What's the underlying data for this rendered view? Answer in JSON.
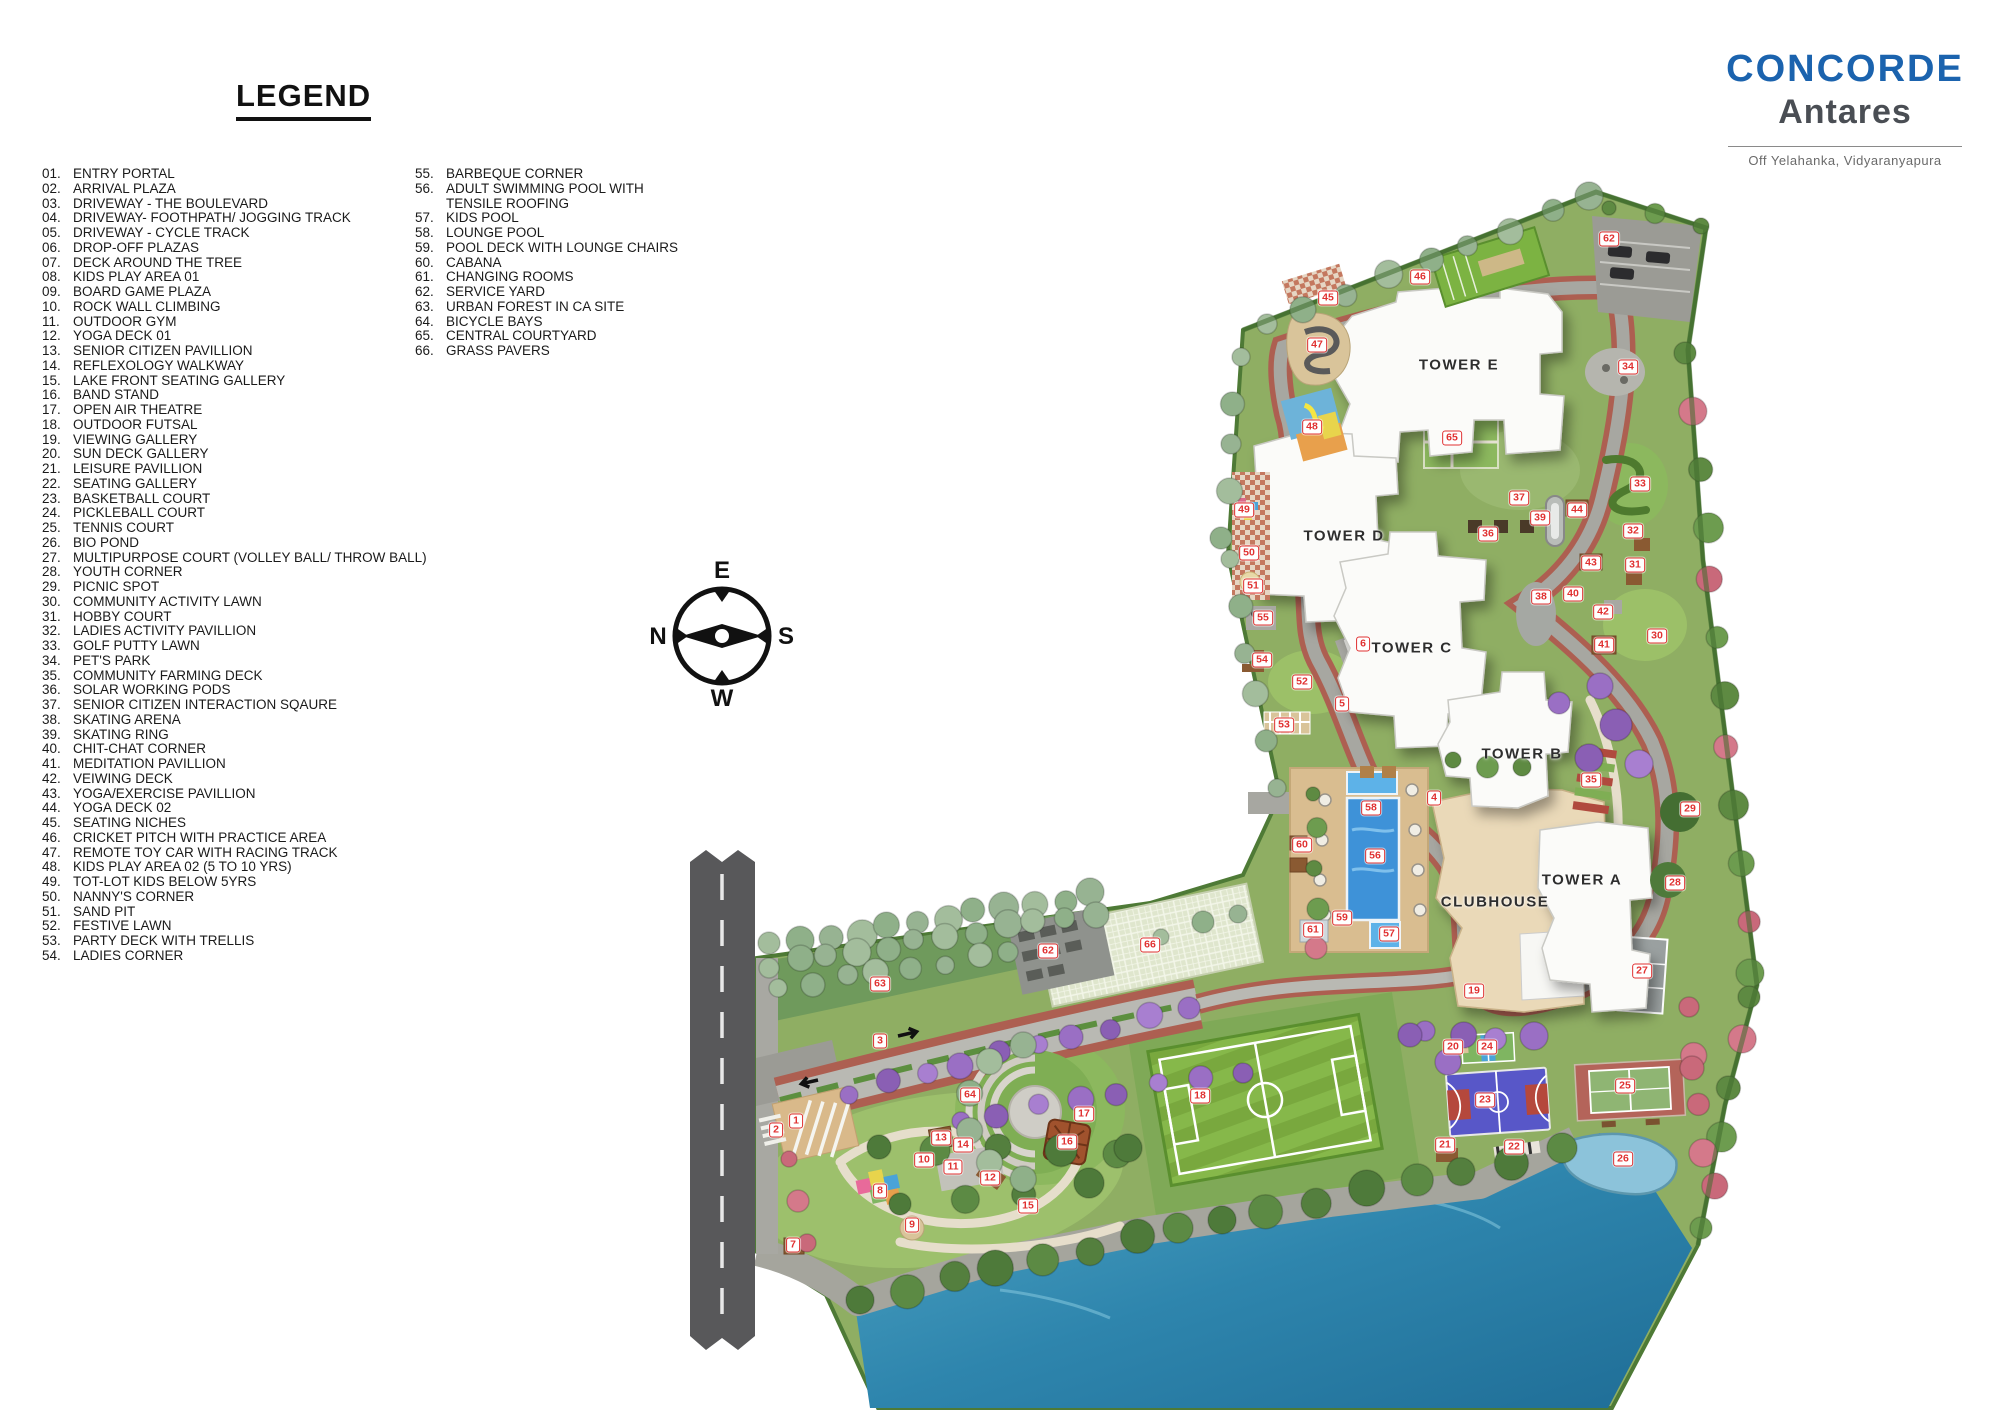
{
  "legend": {
    "title": "LEGEND",
    "column1": [
      {
        "n": "01.",
        "label": "ENTRY PORTAL"
      },
      {
        "n": "02.",
        "label": "ARRIVAL PLAZA"
      },
      {
        "n": "03.",
        "label": "DRIVEWAY - THE BOULEVARD"
      },
      {
        "n": "04.",
        "label": "DRIVEWAY- FOOTHPATH/ JOGGING TRACK"
      },
      {
        "n": "05.",
        "label": "DRIVEWAY - CYCLE TRACK"
      },
      {
        "n": "06.",
        "label": "DROP-OFF PLAZAS"
      },
      {
        "n": "07.",
        "label": "DECK AROUND THE TREE"
      },
      {
        "n": "08.",
        "label": "KIDS PLAY AREA 01"
      },
      {
        "n": "09.",
        "label": "BOARD GAME PLAZA"
      },
      {
        "n": "10.",
        "label": "ROCK WALL CLIMBING"
      },
      {
        "n": "11.",
        "label": "OUTDOOR GYM"
      },
      {
        "n": "12.",
        "label": "YOGA DECK 01"
      },
      {
        "n": "13.",
        "label": "SENIOR CITIZEN PAVILLION"
      },
      {
        "n": "14.",
        "label": "REFLEXOLOGY WALKWAY"
      },
      {
        "n": "15.",
        "label": "LAKE FRONT SEATING GALLERY"
      },
      {
        "n": "16.",
        "label": "BAND STAND"
      },
      {
        "n": "17.",
        "label": "OPEN AIR THEATRE"
      },
      {
        "n": "18.",
        "label": "OUTDOOR FUTSAL"
      },
      {
        "n": "19.",
        "label": "VIEWING GALLERY"
      },
      {
        "n": "20.",
        "label": "SUN DECK GALLERY"
      },
      {
        "n": "21.",
        "label": "LEISURE PAVILLION"
      },
      {
        "n": "22.",
        "label": "SEATING GALLERY"
      },
      {
        "n": "23.",
        "label": "BASKETBALL COURT"
      },
      {
        "n": "24.",
        "label": "PICKLEBALL COURT"
      },
      {
        "n": "25.",
        "label": "TENNIS COURT"
      },
      {
        "n": "26.",
        "label": "BIO POND"
      },
      {
        "n": "27.",
        "label": "MULTIPURPOSE COURT (VOLLEY BALL/ THROW BALL)"
      },
      {
        "n": "28.",
        "label": "YOUTH CORNER"
      },
      {
        "n": "29.",
        "label": "PICNIC SPOT"
      },
      {
        "n": "30.",
        "label": "COMMUNITY ACTIVITY LAWN"
      },
      {
        "n": "31.",
        "label": "HOBBY COURT"
      },
      {
        "n": "32.",
        "label": "LADIES ACTIVITY PAVILLION"
      },
      {
        "n": "33.",
        "label": "GOLF PUTTY LAWN"
      },
      {
        "n": "34.",
        "label": "PET'S PARK"
      },
      {
        "n": "35.",
        "label": "COMMUNITY FARMING DECK"
      },
      {
        "n": "36.",
        "label": "SOLAR WORKING PODS"
      },
      {
        "n": "37.",
        "label": "SENIOR CITIZEN INTERACTION SQAURE"
      },
      {
        "n": "38.",
        "label": "SKATING ARENA"
      },
      {
        "n": "39.",
        "label": "SKATING RING"
      },
      {
        "n": "40.",
        "label": "CHIT-CHAT CORNER"
      },
      {
        "n": "41.",
        "label": "MEDITATION PAVILLION"
      },
      {
        "n": "42.",
        "label": "VEIWING DECK"
      },
      {
        "n": "43.",
        "label": "YOGA/EXERCISE PAVILLION"
      },
      {
        "n": "44.",
        "label": "YOGA DECK 02"
      },
      {
        "n": "45.",
        "label": "SEATING NICHES"
      },
      {
        "n": "46.",
        "label": "CRICKET PITCH WITH PRACTICE AREA"
      },
      {
        "n": "47.",
        "label": "REMOTE TOY CAR WITH RACING TRACK"
      },
      {
        "n": "48.",
        "label": "KIDS PLAY AREA 02 (5 TO 10 YRS)"
      },
      {
        "n": "49.",
        "label": "TOT-LOT KIDS BELOW 5YRS"
      },
      {
        "n": "50.",
        "label": "NANNY'S CORNER"
      },
      {
        "n": "51.",
        "label": "SAND PIT"
      },
      {
        "n": "52.",
        "label": "FESTIVE LAWN"
      },
      {
        "n": "53.",
        "label": "PARTY DECK WITH TRELLIS"
      },
      {
        "n": "54.",
        "label": "LADIES CORNER"
      }
    ],
    "column2": [
      {
        "n": "55.",
        "label": "BARBEQUE CORNER"
      },
      {
        "n": "56.",
        "label": "ADULT SWIMMING POOL WITH\nTENSILE ROOFING"
      },
      {
        "n": "57.",
        "label": "KIDS POOL"
      },
      {
        "n": "58.",
        "label": "LOUNGE POOL"
      },
      {
        "n": "59.",
        "label": "POOL DECK WITH LOUNGE CHAIRS"
      },
      {
        "n": "60.",
        "label": "CABANA"
      },
      {
        "n": "61.",
        "label": "CHANGING ROOMS"
      },
      {
        "n": "62.",
        "label": "SERVICE YARD"
      },
      {
        "n": "63.",
        "label": "URBAN FOREST IN CA SITE"
      },
      {
        "n": "64.",
        "label": "BICYCLE BAYS"
      },
      {
        "n": "65.",
        "label": "CENTRAL COURTYARD"
      },
      {
        "n": "66.",
        "label": "GRASS PAVERS"
      }
    ]
  },
  "logo": {
    "brand": "CONCORDE",
    "project": "Antares",
    "tagline": "Off Yelahanka, Vidyaranyapura"
  },
  "compass": {
    "top": "E",
    "left": "N",
    "right": "S",
    "bottom": "W"
  },
  "colors": {
    "brand_blue": "#1b63ae",
    "brand_gray": "#4a4e54",
    "marker_red": "#e03131",
    "marker_bg": "#ffffff"
  },
  "map": {
    "labels": [
      {
        "text": "TOWER E",
        "x": 1459,
        "y": 365
      },
      {
        "text": "TOWER D",
        "x": 1344,
        "y": 536
      },
      {
        "text": "TOWER C",
        "x": 1412,
        "y": 648
      },
      {
        "text": "TOWER B",
        "x": 1522,
        "y": 754
      },
      {
        "text": "TOWER A",
        "x": 1582,
        "y": 880
      },
      {
        "text": "CLUBHOUSE",
        "x": 1495,
        "y": 902
      }
    ],
    "markers": [
      {
        "n": 1,
        "x": 796,
        "y": 1121
      },
      {
        "n": 2,
        "x": 776,
        "y": 1130
      },
      {
        "n": 3,
        "x": 880,
        "y": 1041
      },
      {
        "n": 4,
        "x": 1434,
        "y": 798
      },
      {
        "n": 5,
        "x": 1342,
        "y": 704
      },
      {
        "n": 6,
        "x": 1363,
        "y": 644
      },
      {
        "n": 7,
        "x": 793,
        "y": 1245
      },
      {
        "n": 8,
        "x": 880,
        "y": 1191
      },
      {
        "n": 9,
        "x": 912,
        "y": 1225
      },
      {
        "n": 10,
        "x": 924,
        "y": 1160
      },
      {
        "n": 11,
        "x": 953,
        "y": 1167
      },
      {
        "n": 12,
        "x": 990,
        "y": 1178
      },
      {
        "n": 13,
        "x": 941,
        "y": 1138
      },
      {
        "n": 14,
        "x": 963,
        "y": 1145
      },
      {
        "n": 15,
        "x": 1028,
        "y": 1206
      },
      {
        "n": 16,
        "x": 1067,
        "y": 1142
      },
      {
        "n": 17,
        "x": 1084,
        "y": 1114
      },
      {
        "n": 18,
        "x": 1200,
        "y": 1096
      },
      {
        "n": 19,
        "x": 1474,
        "y": 991
      },
      {
        "n": 20,
        "x": 1453,
        "y": 1047
      },
      {
        "n": 21,
        "x": 1445,
        "y": 1145
      },
      {
        "n": 22,
        "x": 1514,
        "y": 1147
      },
      {
        "n": 23,
        "x": 1485,
        "y": 1100
      },
      {
        "n": 24,
        "x": 1487,
        "y": 1047
      },
      {
        "n": 25,
        "x": 1625,
        "y": 1086
      },
      {
        "n": 26,
        "x": 1623,
        "y": 1159
      },
      {
        "n": 27,
        "x": 1642,
        "y": 971
      },
      {
        "n": 28,
        "x": 1675,
        "y": 883
      },
      {
        "n": 29,
        "x": 1690,
        "y": 809
      },
      {
        "n": 30,
        "x": 1657,
        "y": 636
      },
      {
        "n": 31,
        "x": 1635,
        "y": 565
      },
      {
        "n": 32,
        "x": 1633,
        "y": 531
      },
      {
        "n": 33,
        "x": 1640,
        "y": 484
      },
      {
        "n": 34,
        "x": 1628,
        "y": 367
      },
      {
        "n": 35,
        "x": 1591,
        "y": 780
      },
      {
        "n": 36,
        "x": 1488,
        "y": 534
      },
      {
        "n": 37,
        "x": 1519,
        "y": 498
      },
      {
        "n": 38,
        "x": 1541,
        "y": 597
      },
      {
        "n": 39,
        "x": 1540,
        "y": 518
      },
      {
        "n": 40,
        "x": 1573,
        "y": 594
      },
      {
        "n": 41,
        "x": 1604,
        "y": 645
      },
      {
        "n": 42,
        "x": 1603,
        "y": 612
      },
      {
        "n": 43,
        "x": 1591,
        "y": 563
      },
      {
        "n": 44,
        "x": 1577,
        "y": 510
      },
      {
        "n": 45,
        "x": 1328,
        "y": 298
      },
      {
        "n": 46,
        "x": 1420,
        "y": 277
      },
      {
        "n": 47,
        "x": 1317,
        "y": 345
      },
      {
        "n": 48,
        "x": 1312,
        "y": 427
      },
      {
        "n": 49,
        "x": 1244,
        "y": 510
      },
      {
        "n": 50,
        "x": 1249,
        "y": 553
      },
      {
        "n": 51,
        "x": 1253,
        "y": 586
      },
      {
        "n": 52,
        "x": 1302,
        "y": 682
      },
      {
        "n": 53,
        "x": 1284,
        "y": 725
      },
      {
        "n": 54,
        "x": 1262,
        "y": 660
      },
      {
        "n": 55,
        "x": 1263,
        "y": 618
      },
      {
        "n": 56,
        "x": 1375,
        "y": 856
      },
      {
        "n": 57,
        "x": 1389,
        "y": 934
      },
      {
        "n": 58,
        "x": 1371,
        "y": 808
      },
      {
        "n": 59,
        "x": 1342,
        "y": 918
      },
      {
        "n": 60,
        "x": 1302,
        "y": 845
      },
      {
        "n": 61,
        "x": 1313,
        "y": 930
      },
      {
        "n": 62,
        "x": 1609,
        "y": 239
      },
      {
        "n": 62,
        "x": 1048,
        "y": 951
      },
      {
        "n": 63,
        "x": 880,
        "y": 984
      },
      {
        "n": 64,
        "x": 970,
        "y": 1095
      },
      {
        "n": 65,
        "x": 1452,
        "y": 438
      },
      {
        "n": 66,
        "x": 1150,
        "y": 945
      }
    ]
  }
}
